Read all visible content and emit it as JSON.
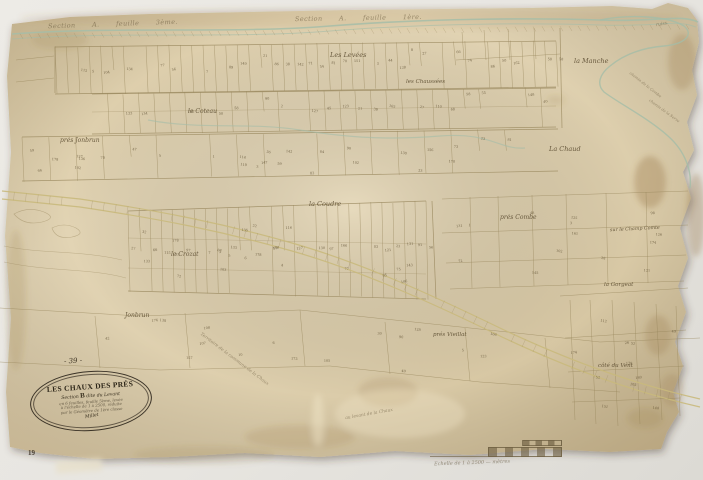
{
  "colors": {
    "backdrop": "#e9e7e2",
    "paper": "#ddcfae",
    "ink": "#97865b",
    "ink_dark": "#5b4c30",
    "water": "#a4bda8",
    "road": "#c9b97c"
  },
  "cartouche": {
    "title": "LES CHAUX DES PRÉS",
    "section_prefix": "Section",
    "section_letter": "B",
    "section_suffix": "dite du Levant",
    "line_3": "en 6 feuilles, feuille 5ème, levée",
    "line_4": "à l'échelle de 1 à 2500, réduite",
    "line_5": "par le Géomètre de 1ère classe",
    "signature": "Millet"
  },
  "scale_bar": {
    "caption": "Echelle de 1 à 2500 — mètres"
  },
  "map": {
    "labels": [
      {
        "name": "plate-number",
        "text": "- 39 -",
        "x": 64,
        "y": 357,
        "rot": -3,
        "size": 7,
        "cls": "dark"
      },
      {
        "name": "page-number",
        "text": "19",
        "x": 28,
        "y": 449,
        "rot": 0,
        "size": 7,
        "cls": "print"
      },
      {
        "name": "section-header-left",
        "text": "Section A. feuille 3ème.",
        "x": 48,
        "y": 20,
        "rot": -2,
        "size": 6.5,
        "cls": "spread faint"
      },
      {
        "name": "section-header-center",
        "text": "Section A. feuille 1ère.",
        "x": 295,
        "y": 14,
        "rot": -1,
        "size": 6.5,
        "cls": "spread faint"
      },
      {
        "name": "stream-label",
        "text": "ruiss.",
        "x": 656,
        "y": 22,
        "rot": -10,
        "size": 4.5,
        "cls": "faint"
      },
      {
        "name": "lieu-dit",
        "text": "Les Levées",
        "x": 330,
        "y": 51,
        "rot": 0,
        "size": 6.5,
        "cls": ""
      },
      {
        "name": "lieu-dit",
        "text": "la Manche",
        "x": 574,
        "y": 57,
        "rot": 0,
        "size": 6.5,
        "cls": ""
      },
      {
        "name": "lieu-dit",
        "text": "les Chaussées",
        "x": 406,
        "y": 79,
        "rot": 0,
        "size": 5.5,
        "cls": ""
      },
      {
        "name": "lieu-dit",
        "text": "le Coteau",
        "x": 188,
        "y": 108,
        "rot": 0,
        "size": 6,
        "cls": ""
      },
      {
        "name": "lieu-dit",
        "text": "prés Jonbrun",
        "x": 60,
        "y": 137,
        "rot": 0,
        "size": 6,
        "cls": ""
      },
      {
        "name": "lieu-dit",
        "text": "La Chaud",
        "x": 549,
        "y": 145,
        "rot": 0,
        "size": 6.5,
        "cls": ""
      },
      {
        "name": "lieu-dit",
        "text": "la Coudre",
        "x": 309,
        "y": 200,
        "rot": 0,
        "size": 6.5,
        "cls": ""
      },
      {
        "name": "lieu-dit",
        "text": "prés Combe",
        "x": 500,
        "y": 214,
        "rot": 0,
        "size": 6,
        "cls": ""
      },
      {
        "name": "lieu-dit",
        "text": "sur le Champ Comte",
        "x": 610,
        "y": 227,
        "rot": -3,
        "size": 4.8,
        "cls": ""
      },
      {
        "name": "lieu-dit",
        "text": "le Crozat",
        "x": 171,
        "y": 251,
        "rot": 0,
        "size": 6,
        "cls": ""
      },
      {
        "name": "lieu-dit",
        "text": "la Gorgeat",
        "x": 604,
        "y": 282,
        "rot": 0,
        "size": 5.5,
        "cls": ""
      },
      {
        "name": "lieu-dit",
        "text": "Jonbrun",
        "x": 125,
        "y": 312,
        "rot": 0,
        "size": 6,
        "cls": ""
      },
      {
        "name": "lieu-dit",
        "text": "prés Vieillat",
        "x": 433,
        "y": 332,
        "rot": 0,
        "size": 5.5,
        "cls": ""
      },
      {
        "name": "lieu-dit",
        "text": "côté du Vent",
        "x": 598,
        "y": 363,
        "rot": 0,
        "size": 5.5,
        "cls": ""
      },
      {
        "name": "road-label",
        "text": "chemin de la Combe",
        "x": 626,
        "y": 82,
        "rot": 38,
        "size": 3.8,
        "cls": "faint"
      },
      {
        "name": "road-label",
        "text": "chemin de la Serve",
        "x": 646,
        "y": 108,
        "rot": 36,
        "size": 3.8,
        "cls": "faint"
      },
      {
        "name": "territory-note",
        "text": "Territoire de la commune de la Chaux",
        "x": 192,
        "y": 357,
        "rot": 37,
        "size": 4.4,
        "cls": "faint"
      },
      {
        "name": "margin-note",
        "text": "au levant de la Chaux",
        "x": 345,
        "y": 412,
        "rot": -10,
        "size": 4.4,
        "cls": "faint"
      }
    ]
  }
}
